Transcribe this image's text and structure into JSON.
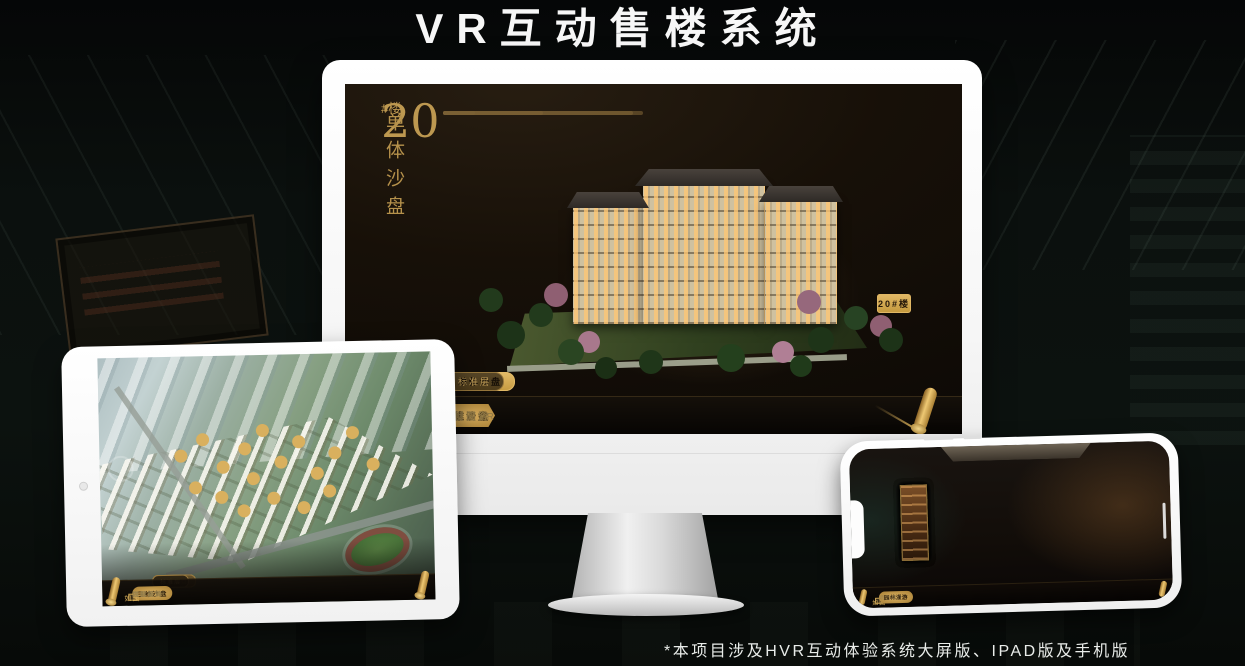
{
  "page": {
    "title": "VR互动售楼系统",
    "footnote": "*本项目涉及HVR互动体验系统大屏版、IPAD版及手机版"
  },
  "brand": {
    "name": "如园"
  },
  "colors": {
    "gold": "#c9a050",
    "gold_bright": "#e2ba67",
    "screen_bg": "#171008",
    "device_white": "#ffffff"
  },
  "desktop": {
    "unit": {
      "number": "20",
      "suffix": "#楼",
      "subtitle": "单体沙盘"
    },
    "floor_buttons": [
      {
        "label": "3#楼",
        "active": false
      },
      {
        "label": "6#楼",
        "active": false
      },
      {
        "label": "8#楼",
        "active": false
      },
      {
        "label": "20#楼",
        "active": true
      }
    ],
    "view_tabs": [
      {
        "label": "项目沙盘",
        "active": false
      },
      {
        "label": "单体沙盘",
        "active": true
      },
      {
        "label": "标准层",
        "active": false
      }
    ],
    "nav": [
      {
        "label": "区位交通",
        "active": false
      },
      {
        "label": "三维沙盘",
        "active": true
      },
      {
        "label": "样板间VR",
        "active": false
      },
      {
        "label": "户型鉴赏",
        "active": false
      },
      {
        "label": "园林漫游",
        "active": false
      },
      {
        "label": "项目简介",
        "active": false
      }
    ],
    "logo": "如园"
  },
  "tablet": {
    "view_tabs": [
      {
        "label": "项目沙盘",
        "active": true
      },
      {
        "label": "单体沙盘",
        "active": false
      },
      {
        "label": "标准层",
        "active": false
      }
    ],
    "nav": [
      {
        "label": "区位交通",
        "active": false
      },
      {
        "label": "三维沙盘",
        "active": true
      },
      {
        "label": "样板间VR",
        "active": false
      },
      {
        "label": "户型鉴赏",
        "active": false
      },
      {
        "label": "园林漫游",
        "active": false
      },
      {
        "label": "项目简介",
        "active": false
      }
    ],
    "logo": "如园"
  },
  "phone": {
    "nav": [
      {
        "label": "区位交通",
        "active": false
      },
      {
        "label": "三维沙盘",
        "active": false
      },
      {
        "label": "样板间VR",
        "active": false
      },
      {
        "label": "户型鉴赏",
        "active": false
      },
      {
        "label": "园林漫游",
        "active": true
      },
      {
        "label": "项目简介",
        "active": false
      }
    ],
    "logo": "如园"
  }
}
